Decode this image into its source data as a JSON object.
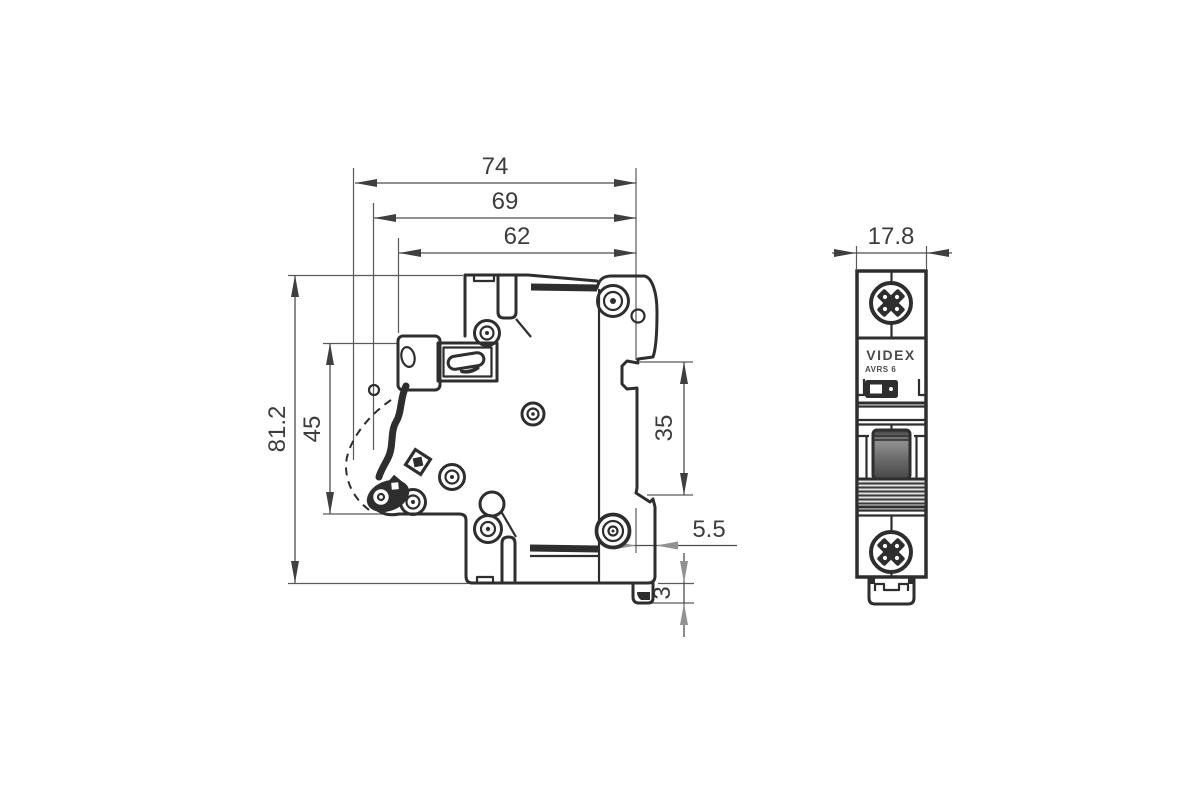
{
  "colors": {
    "line": "#2e2e2e",
    "dimension": "#3d3d3d",
    "gray_arrow": "#929292",
    "toggle_dark": "#4a4a4a",
    "background": "#ffffff"
  },
  "side_view": {
    "dimensions": {
      "overall_width": "74",
      "mid_width": "69",
      "body_width": "62",
      "overall_height": "81.2",
      "front_height": "45",
      "din_rail_height": "35",
      "rear_offset": "5.5",
      "foot_height": "3"
    }
  },
  "front_view": {
    "dimensions": {
      "width": "17.8"
    },
    "brand": "VIDEX",
    "model": "AVRS 6"
  }
}
